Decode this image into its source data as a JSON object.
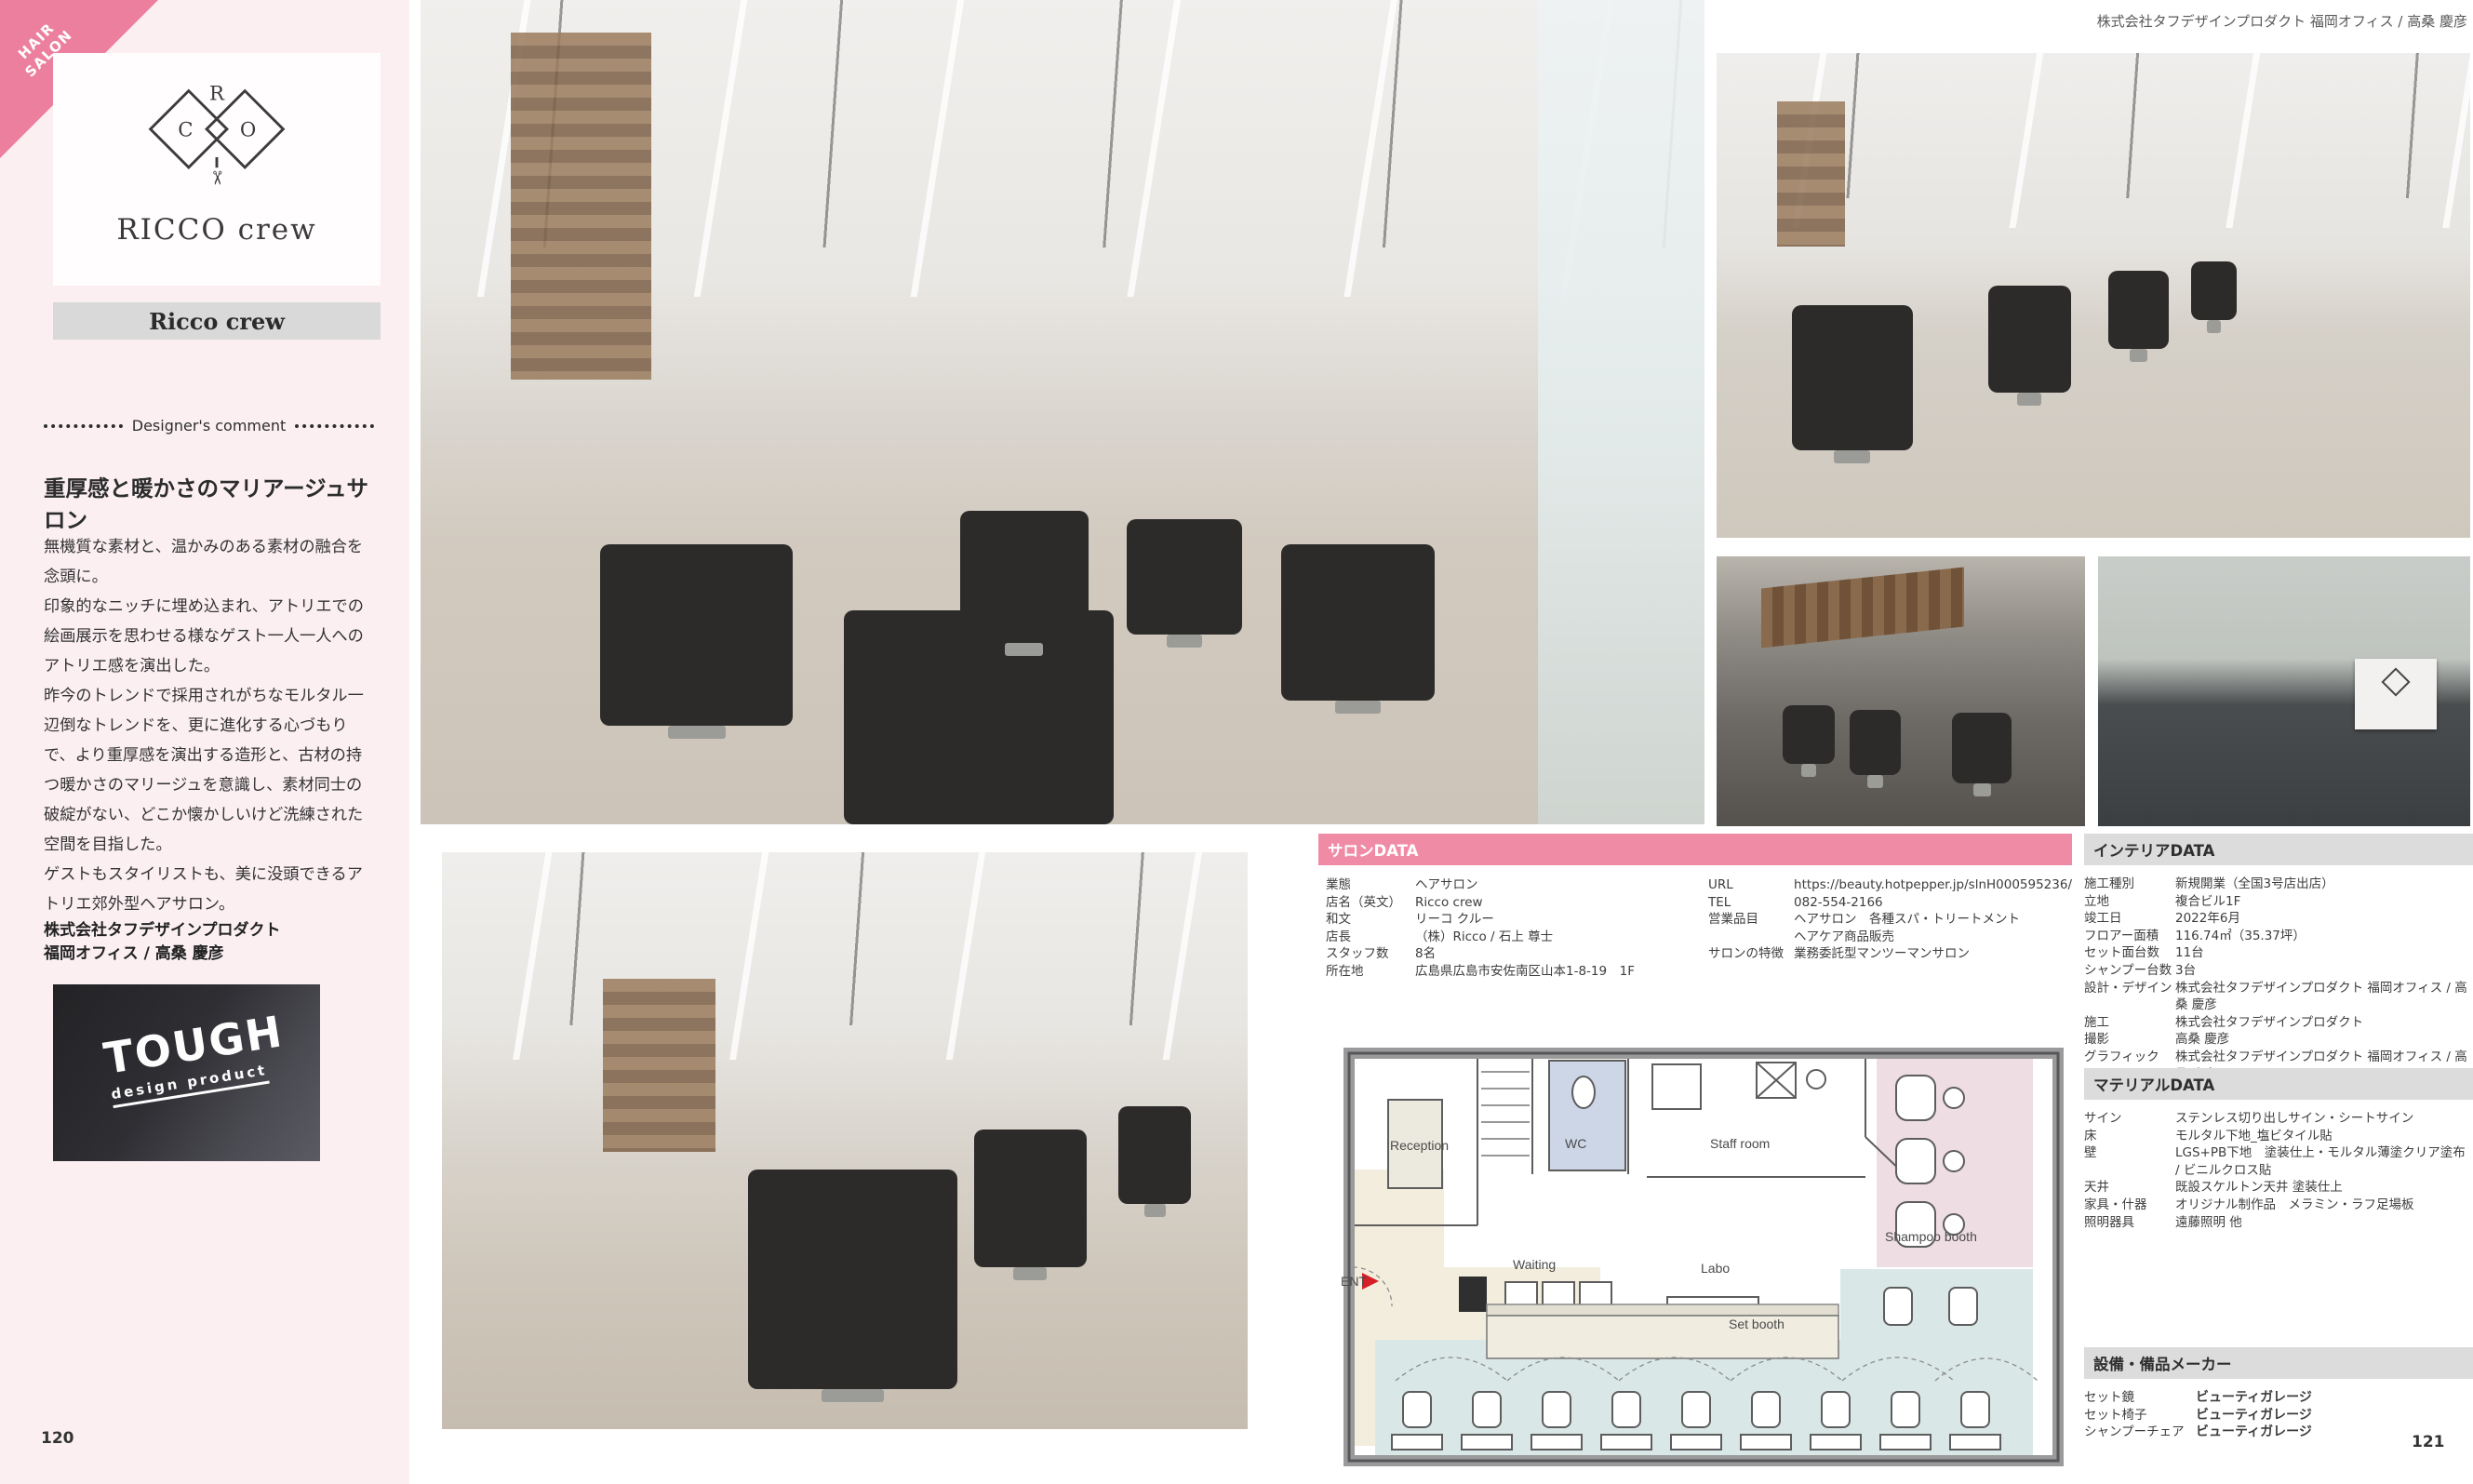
{
  "page": {
    "left_page_number": "120",
    "right_page_number": "121",
    "credit_top_right": "株式会社タフデザインプロダクト 福岡オフィス / 高桑 慶彦"
  },
  "colors": {
    "accent_pink_bar": "#f08ba6",
    "corner_tag_pink": "#ec7f9e",
    "sidebar_pink": "#fbeff2",
    "section_bar_gray": "#dcdcdc",
    "plan_set_booth_teal": "#d9e8e6",
    "plan_shampoo_pink": "#eedde3",
    "plan_entry_beige": "#f3edde",
    "plan_wc_blue": "#cdd6e7",
    "entrance_arrow_red": "#d61f26"
  },
  "icons": {
    "scissors": "✂"
  },
  "sidebar": {
    "category_tag": {
      "line1": "HAIR",
      "line2": "SALON"
    },
    "logo": {
      "letter_r": "R",
      "letter_c": "C",
      "letter_o": "O",
      "title": "RICCO crew"
    },
    "name_bar": "Ricco crew",
    "comment": {
      "header": "Designer's comment",
      "title": "重厚感と暖かさのマリアージュサロン",
      "paragraphs": [
        "無機質な素材と、温かみのある素材の融合を念頭に。",
        "印象的なニッチに埋め込まれ、アトリエでの絵画展示を思わせる様なゲスト一人一人へのアトリエ感を演出した。",
        "昨今のトレンドで採用されがちなモルタル一辺倒なトレンドを、更に進化する心づもりで、より重厚感を演出する造形と、古材の持つ暖かさのマリージュを意識し、素材同士の破綻がない、どこか懐かしいけど洗練された空間を目指した。",
        "ゲストもスタイリストも、美に没頭できるアトリエ郊外型ヘアサロン。"
      ],
      "firm_line1": "株式会社タフデザインプロダクト",
      "firm_line2": "福岡オフィス / 高桑 慶彦"
    },
    "tough_sign": {
      "line1": "TOUGH",
      "line2": "design product"
    }
  },
  "salon_data": {
    "header": "サロンDATA",
    "left_rows": [
      {
        "label": "業態",
        "value": "ヘアサロン"
      },
      {
        "label": "店名（英文）",
        "value": "Ricco crew"
      },
      {
        "label": "和文",
        "value": "リーコ クルー"
      },
      {
        "label": "店長",
        "value": "（株）Ricco / 石上 尊士"
      },
      {
        "label": "スタッフ数",
        "value": "8名"
      },
      {
        "label": "所在地",
        "value": "広島県広島市安佐南区山本1-8-19　1F"
      }
    ],
    "right_rows": [
      {
        "label": "URL",
        "value": "https://beauty.hotpepper.jp/slnH000595236/"
      },
      {
        "label": "TEL",
        "value": "082-554-2166"
      },
      {
        "label": "営業品目",
        "value": "ヘアサロン　各種スパ・トリートメント\nヘアケア商品販売"
      },
      {
        "label": "サロンの特徴",
        "value": "業務委託型マンツーマンサロン"
      }
    ]
  },
  "interior_data": {
    "header": "インテリアDATA",
    "rows": [
      {
        "label": "施工種別",
        "value": "新規開業（全国3号店出店）"
      },
      {
        "label": "立地",
        "value": "複合ビル1F"
      },
      {
        "label": "竣工日",
        "value": "2022年6月"
      },
      {
        "label": "フロアー面積",
        "value": "116.74㎡（35.37坪）"
      },
      {
        "label": "セット面台数",
        "value": "11台"
      },
      {
        "label": "シャンプー台数",
        "value": "3台"
      },
      {
        "label": "設計・デザイン",
        "value": "株式会社タフデザインプロダクト 福岡オフィス / 高桑 慶彦"
      },
      {
        "label": "施工",
        "value": "株式会社タフデザインプロダクト"
      },
      {
        "label": "撮影",
        "value": "高桑 慶彦"
      },
      {
        "label": "グラフィック",
        "value": "株式会社タフデザインプロダクト 福岡オフィス / 高桑 慶彦"
      }
    ]
  },
  "material_data": {
    "header": "マテリアルDATA",
    "rows": [
      {
        "label": "サイン",
        "value": "ステンレス切り出しサイン・シートサイン"
      },
      {
        "label": "床",
        "value": "モルタル下地_塩ビタイル貼"
      },
      {
        "label": "壁",
        "value": "LGS+PB下地　塗装仕上・モルタル薄塗クリア塗布 / ビニルクロス貼"
      },
      {
        "label": "天井",
        "value": "既設スケルトン天井 塗装仕上"
      },
      {
        "label": "家具・什器",
        "value": "オリジナル制作品　メラミン・ラフ足場板"
      },
      {
        "label": "照明器具",
        "value": "遠藤照明 他"
      }
    ]
  },
  "equipment_makers": {
    "header": "設備・備品メーカー",
    "rows": [
      {
        "label": "セット鏡",
        "value": "ビューティガレージ"
      },
      {
        "label": "セット椅子",
        "value": "ビューティガレージ"
      },
      {
        "label": "シャンプーチェア",
        "value": "ビューティガレージ"
      }
    ]
  },
  "floor_plan": {
    "labels": {
      "reception": "Reception",
      "wc": "WC",
      "staff_room": "Staff room",
      "shampoo_booth": "Shampoo booth",
      "waiting": "Waiting",
      "labo": "Labo",
      "set_booth": "Set booth",
      "entrance": "ENT"
    }
  }
}
